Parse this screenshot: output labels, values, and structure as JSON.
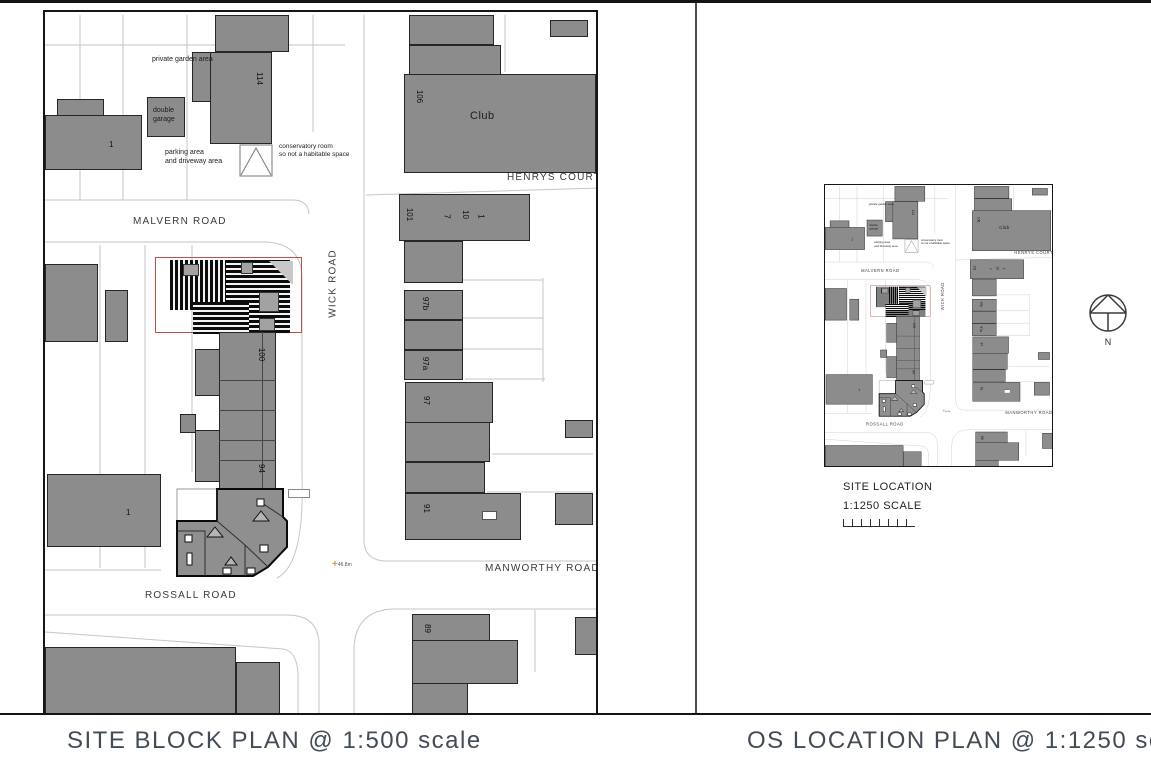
{
  "captions": {
    "left": "SITE BLOCK PLAN @ 1:500 scale",
    "right": "OS LOCATION PLAN @ 1:1250 scale"
  },
  "block_plan": {
    "roads": {
      "malvern": "MALVERN ROAD",
      "wick": "WICK ROAD",
      "henrys_court": "HENRYS COURT",
      "manworthy": "MANWORTHY ROAD",
      "rossall": "ROSSALL ROAD"
    },
    "labels": {
      "private_garden": "private garden area",
      "double_garage": "double\ngarage",
      "parking": "parking area\nand driveway area",
      "conservatory": "conservatory room\nso not a habitable space",
      "club": "Club",
      "spot_level": "46.8m"
    },
    "house_numbers": {
      "malvern_114": "114",
      "malvern_1": "1",
      "club_106": "106",
      "court_101": "101",
      "court_7": "7",
      "court_10": "10",
      "court_1": "1",
      "wick_97b": "97b",
      "wick_97a": "97a",
      "wick_97": "97",
      "wick_100": "100",
      "wick_94": "94",
      "wick_91": "91",
      "wick_89": "89",
      "rossall_1": "1"
    }
  },
  "location_plan": {
    "title": "SITE LOCATION",
    "scale": "1:1250 SCALE",
    "north": "N"
  },
  "colors": {
    "building_gray": "#8c8c8c",
    "outline_black": "#262626",
    "parcel_line": "#c6c6c6",
    "site_boundary_red": "#c0504d",
    "caption_text": "#434b57",
    "spot_marker_orange": "#d59a3b"
  }
}
